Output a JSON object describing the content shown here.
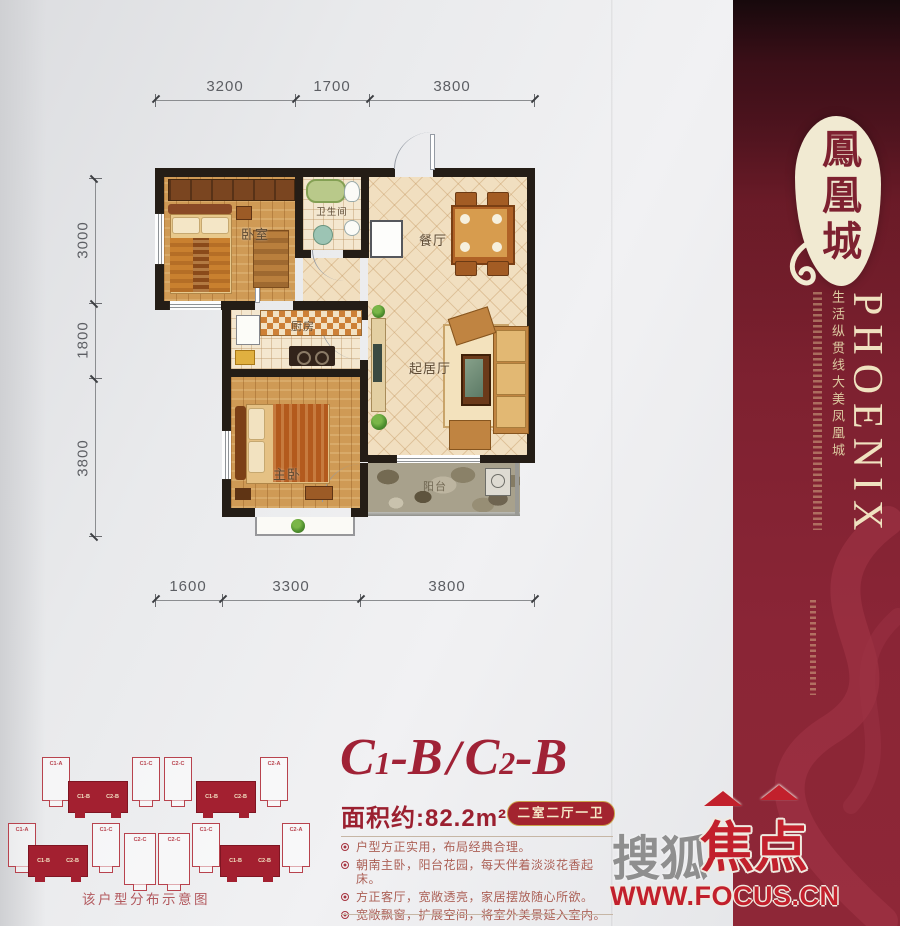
{
  "dimensions": {
    "top": [
      "3200",
      "1700",
      "3800"
    ],
    "left": [
      "3000",
      "1800",
      "3800"
    ],
    "bottom": [
      "1600",
      "3300",
      "3800"
    ]
  },
  "rooms": {
    "bedroom": "卧室",
    "bathroom": "卫生间",
    "dining": "餐厅",
    "kitchen": "厨房",
    "living": "起居厅",
    "master": "主卧",
    "balcony": "阳台"
  },
  "unit": {
    "title_parts": [
      "C",
      "1",
      "-B",
      "/",
      "C",
      "2",
      "-B"
    ],
    "area": "面积约:82.2m²",
    "badge": "二室二厅一卫",
    "features": [
      "户型方正实用，布局经典合理。",
      "朝南主卧，阳台花园，每天伴着淡淡花香起床。",
      "方正客厅，宽敞透亮，家居摆放随心所欲。",
      "宽敞飘窗，扩展空间，将室外美景延入室内。"
    ]
  },
  "sidebar": {
    "brand_cn": "鳳凰城",
    "brand_en": "PHOENIX",
    "slogan_1": "生活纵贯线",
    "slogan_2": "大美凤凰城",
    "colors": {
      "bg_main": "#7e2130",
      "accent": "#a83a4c",
      "cream": "#f1ead2"
    }
  },
  "site_plan": {
    "caption": "该户型分布示意图",
    "highlight": [
      "C1-B",
      "C2-B"
    ],
    "row1_outlines": [
      "C1-A",
      "C1-C",
      "C2-C",
      "C2-A"
    ],
    "row2_outlines": [
      "C1-A",
      "C1-C",
      "C2-C",
      "C2-C",
      "C1-C",
      "C2-A"
    ]
  },
  "footer_logo": {
    "sohu": "搜狐",
    "jiaodian": "焦点",
    "url": "WWW.FOCUS.CN",
    "red": "#c2202c"
  }
}
